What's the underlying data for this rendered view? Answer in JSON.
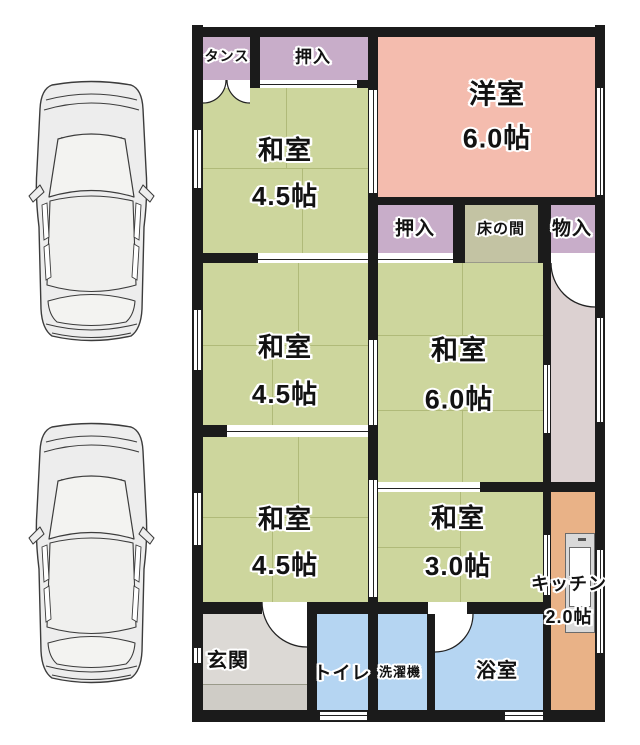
{
  "title": "間取り図",
  "floorplan": {
    "tansu": {
      "label": "タンス"
    },
    "oshiire_top": {
      "label": "押入"
    },
    "western_room": {
      "name": "洋室",
      "size": "6.0帖"
    },
    "washitsu_a": {
      "name": "和室",
      "size": "4.5帖"
    },
    "oshiire_mid": {
      "label": "押入"
    },
    "tokonoma": {
      "label": "床の間"
    },
    "monoire": {
      "label": "物入"
    },
    "washitsu_b": {
      "name": "和室",
      "size": "4.5帖"
    },
    "washitsu_c": {
      "name": "和室",
      "size": "6.0帖"
    },
    "washitsu_d": {
      "name": "和室",
      "size": "4.5帖"
    },
    "washitsu_e": {
      "name": "和室",
      "size": "3.0帖"
    },
    "kitchen": {
      "name": "キッチン",
      "size": "2.0帖"
    },
    "genkan": {
      "label": "玄関"
    },
    "toilet": {
      "label": "トイレ"
    },
    "laundry": {
      "label": "洗濯機"
    },
    "bath": {
      "label": "浴室"
    }
  },
  "parking": {
    "car_illustrations": 2
  },
  "palette": {
    "wall": "#1b1b1b",
    "tatami_green": "#cdd69d",
    "tatami_seam": "#aab573",
    "western_pink": "#f4bcae",
    "closet_lavender": "#c8adc9",
    "tokonoma_olive": "#c3c3a3",
    "corridor_gray": "#dcd1d1",
    "kitchen_orange": "#e9b287",
    "wet_area_blue": "#b5d5f2",
    "genkan_upper": "#dcd9d5",
    "genkan_lower": "#cfccc6",
    "car_body": "#ededed"
  }
}
